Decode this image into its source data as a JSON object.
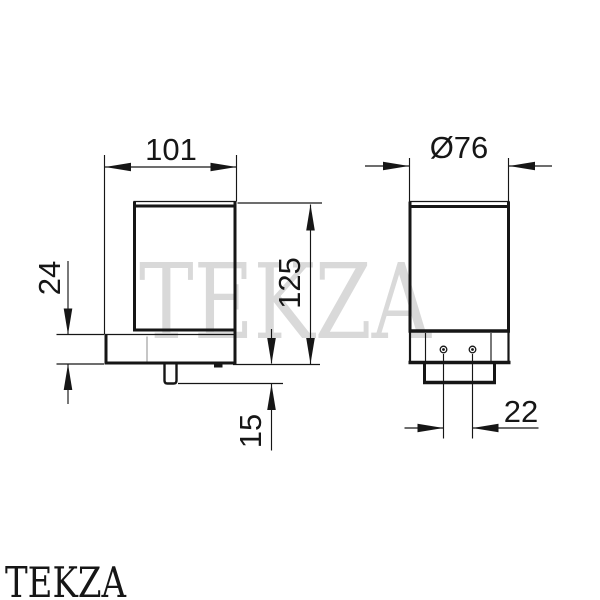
{
  "drawing": {
    "kind": "dimensioned technical drawing, two orthographic views of a wall-mounted soap dispenser",
    "line_color": "#161616",
    "hidden_line_color": "#b3b3b3",
    "background": "#ffffff"
  },
  "labels": {
    "side_width": "101",
    "side_bracket_height": "24",
    "side_total_height": "125",
    "side_spout": "15",
    "front_diameter": "Ø76",
    "front_hole_spacing": "22"
  },
  "dimensions": {
    "side_view": {
      "overall_projection_mm": 101,
      "bracket_thickness_mm": 24,
      "overall_height_mm": 125,
      "spout_length_mm": 15
    },
    "front_view": {
      "body_diameter_mm": 76,
      "screw_hole_spacing_mm": 22
    }
  },
  "watermark": {
    "text": "TEKZA",
    "color": "#d9d9d9"
  },
  "brand": {
    "text": "TEKZA",
    "color": "#161616"
  }
}
